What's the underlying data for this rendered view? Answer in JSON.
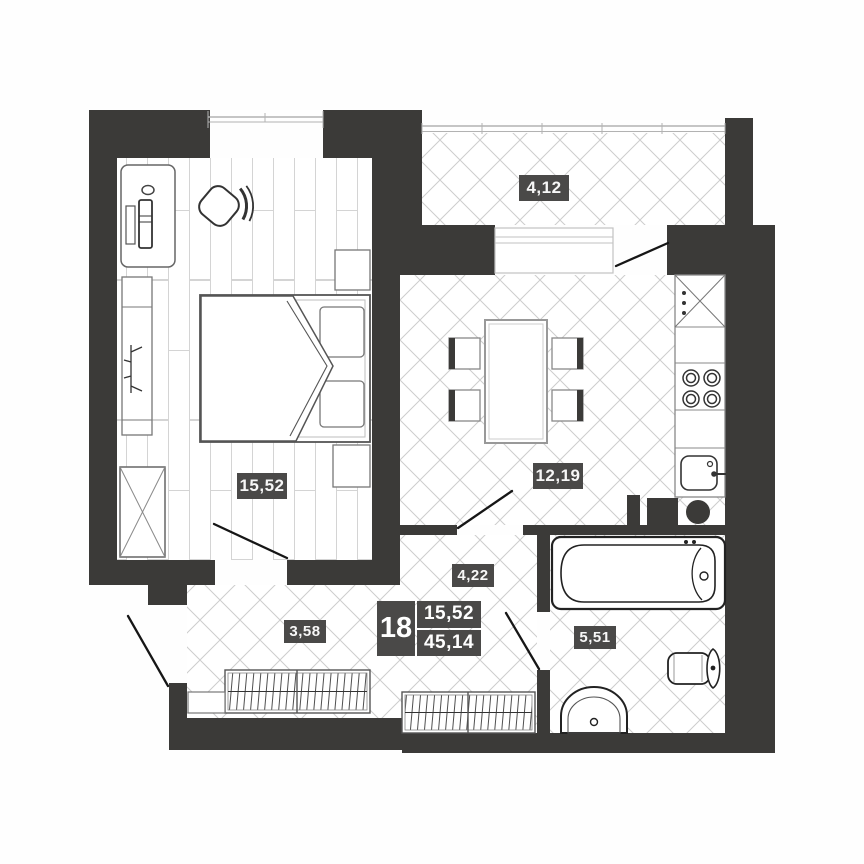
{
  "title": "Apartment floor plan",
  "info_badge": {
    "apartment_number": "18",
    "living_area": "15,52",
    "total_area": "45,14"
  },
  "rooms": {
    "bedroom": {
      "label": "15,52"
    },
    "kitchen": {
      "label": "12,19"
    },
    "balcony": {
      "label": "4,12"
    },
    "corridor": {
      "label": "4,22"
    },
    "hallway": {
      "label": "3,58"
    },
    "bathroom": {
      "label": "5,51"
    }
  },
  "colors": {
    "wall": "#3b3a38",
    "label_background": "#4a4948",
    "label_text": "#f7f7f7",
    "floor_line": "#cdcdcd"
  }
}
